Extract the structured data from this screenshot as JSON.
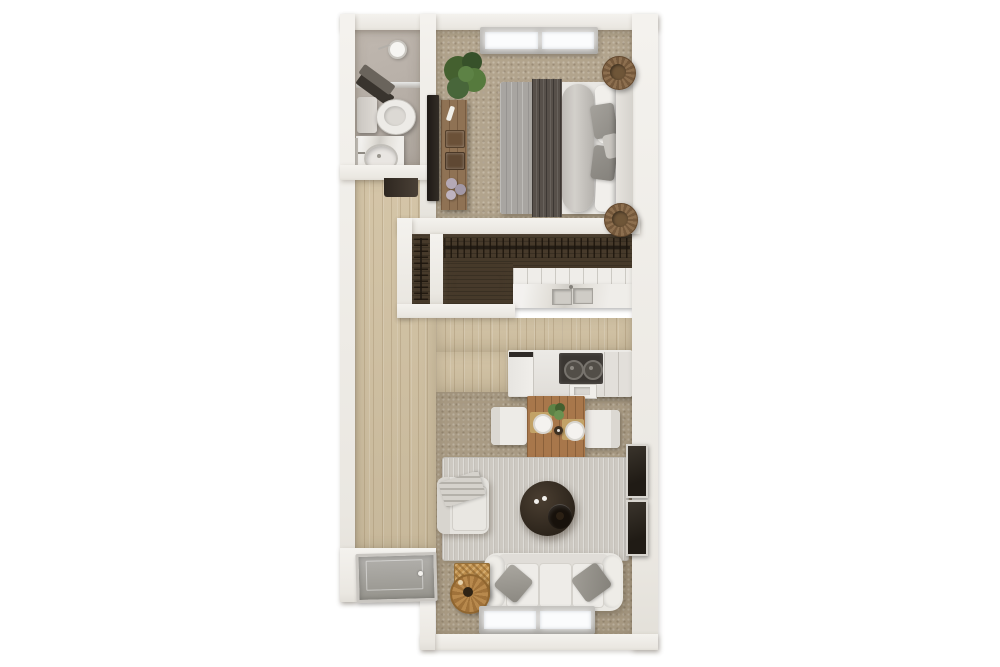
{
  "scene": {
    "kind": "3d-apartment-floor-plan-top-view",
    "width_px": 1000,
    "height_px": 667,
    "background": "#ffffff",
    "text_content": "none — rendering contains no visible text"
  },
  "palette": {
    "wall": "#efede8",
    "wood_floor": "#d2c2a3",
    "bedroom_carpet": "#b2a48d",
    "living_carpet": "#a99b84",
    "closet_floor": "#473a2b",
    "bathroom_floor": "#b7afa7",
    "area_rug": "#cdc9c2",
    "sofa": "#e9e7e2",
    "bed_blanket_gray": "#a8a5a1",
    "bed_throw_dark": "#5a534b",
    "dining_table_wood": "#a8774b",
    "coffee_table_dark": "#31281f",
    "wicker_tan": "#c0914f",
    "plant_green": "#4a6535",
    "front_door_gray": "#a3a19c",
    "stove_black": "#3b3733",
    "window_frame": "#b3b1ad"
  },
  "rooms": [
    {
      "id": "bathroom",
      "floor": "#b7afa7",
      "fixtures": [
        "shower",
        "towels",
        "toilet",
        "sink-vanity",
        "door-threshold"
      ]
    },
    {
      "id": "bedroom",
      "floor": "#b2a48d",
      "fixtures": [
        "window",
        "plant",
        "tv",
        "media-console",
        "double-bed",
        "pouf-top",
        "pouf-bottom"
      ]
    },
    {
      "id": "closet",
      "floor": "#473a2b",
      "fixtures": [
        "hanging-rod-main",
        "hanging-rod-side"
      ]
    },
    {
      "id": "kitchen",
      "floor": "#d2c2a3",
      "fixtures": [
        "upper-counter-with-sink",
        "lower-counter-with-stove",
        "refrigerator"
      ]
    },
    {
      "id": "dining",
      "floor": "#a99b84",
      "fixtures": [
        "wood-table",
        "chair-left",
        "chair-right",
        "plates",
        "centerpiece-plant",
        "bottle"
      ]
    },
    {
      "id": "living",
      "floor": "#a99b84",
      "fixtures": [
        "area-rug",
        "armchair",
        "coffee-table",
        "sofa",
        "throw-pillows",
        "wicker-side-table",
        "art-frames",
        "window"
      ]
    },
    {
      "id": "entry",
      "floor": "#d2c2a3",
      "fixtures": [
        "front-door"
      ]
    }
  ],
  "titles": {
    "floor_plan": "Apartment floor plan (3D top view)",
    "bathroom": "Bathroom",
    "bedroom": "Bedroom",
    "closet": "Closet",
    "kitchen": "Kitchen",
    "dining": "Dining area",
    "living": "Living room",
    "entry": "Entry",
    "hallway": "Hallway",
    "shower": "Shower",
    "toilet": "Toilet",
    "bathroom_sink": "Sink vanity",
    "towels": "Towels",
    "bed": "Bed",
    "headboard": "Headboard",
    "plant": "Plant",
    "tv": "Wall TV",
    "console": "Media console",
    "pouf": "Round pouf",
    "window": "Window",
    "wardrobe_rod": "Closet hanging rod with hangers",
    "upper_counter": "Kitchen counter with sink",
    "lower_counter": "Kitchen counter with stove",
    "fridge": "Refrigerator",
    "stove": "Stove",
    "kitchen_sink": "Kitchen sink",
    "dining_table": "Dining table",
    "chair": "Dining chair",
    "plate": "Place setting",
    "rug": "Area rug",
    "armchair": "Armchair",
    "coffee_table": "Round coffee table",
    "sofa": "Sofa",
    "pillow": "Throw pillow",
    "wicker_table": "Wicker side table",
    "art": "Wall art frame",
    "front_door": "Front door"
  }
}
